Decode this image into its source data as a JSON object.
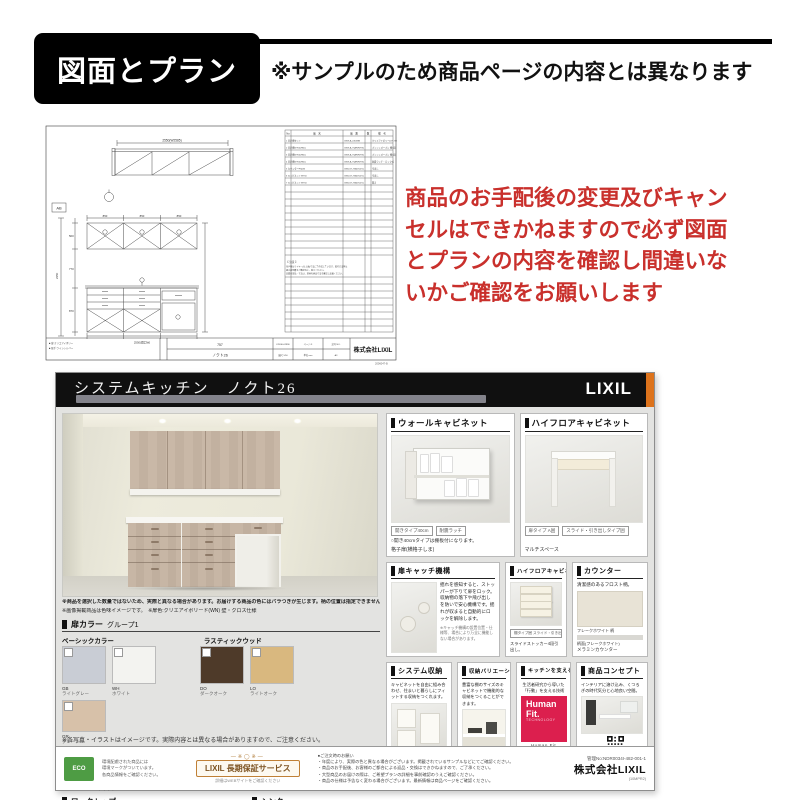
{
  "header": {
    "title": "図面とプラン",
    "disclaimer": "※サンプルのため商品ページの内容とは異なります"
  },
  "warning": {
    "line1": "商品のお手配後の変更及びキャン",
    "line2": "セルはできかねますので必ず図面",
    "line3": "とプランの内容を確認し間違いな",
    "line4": "いかご確認をお願いします"
  },
  "colors": {
    "accent_red": "#c9302c",
    "lixil_orange": "#dd731c",
    "human_fit_red": "#dc1f4e",
    "eco_green": "#4e9c44"
  },
  "drawing": {
    "plan_dim": "2550(W2585)",
    "ref_box": "AB",
    "dim_850a": "850",
    "dim_850b": "850",
    "dim_850c": "850",
    "dim_total": "2550(間口W)",
    "dim_h1": "500",
    "dim_h2": "770",
    "dim_h3": "870",
    "dim_htotal": "2350",
    "tbl_h_no": "No",
    "tbl_h_name": "品　名",
    "tbl_h_code": "品　番",
    "tbl_h_qty": "数",
    "tbl_h_note": "備　考",
    "rows": [
      {
        "a": "1 吊戸棚セット",
        "b": "GKW-A-245ZBN",
        "c": "クリエアイボリー(LH-755)"
      },
      {
        "a": "2 吊戸棚W750(H50)",
        "b": "GKW-A-75AF(R/TN)",
        "c": "プッシュオープン 棚1段"
      },
      {
        "a": "3 吊戸棚W750(H50)",
        "b": "GKW-A-75AF(R/TN)",
        "c": "プッシュオープン 棚1段"
      },
      {
        "a": "4 吊戸棚W750(H50)",
        "b": "GKW-A-75AF(R/TN)",
        "c": "耐震ラッチ・ロック式"
      },
      {
        "a": "5 カウンターFS(W)",
        "b": "GKB-ST-75A6T(2%)",
        "c": "引出し"
      },
      {
        "a": "6 キャビネットW750",
        "b": "GKB-ST-75A6T(2%)",
        "c": "引出し"
      },
      {
        "a": "7 キャビネットW750",
        "b": "GKB-ST-75A6T(2%)",
        "c": "開き"
      }
    ],
    "note1": "【 注意 】",
    "note2a": "吊戸棚はワイヤー(仕上面)寸法にて作成しています。取付方法等は",
    "note2b": "組立説明書をご確認の上、施工ください。",
    "note3": "記載の部品・寸法は、現地の納品寸法を確認し設置ください。",
    "tb_left1": "■ 扉:クリエアイボリー",
    "tb_left2": "■ 取手:ラインシルバー",
    "tb_mid_top": "757",
    "tb_mid_bottom": "ノクト26",
    "g1": "K2630-02996",
    "g2": "ページ-3",
    "g3": "記号 NO.",
    "g4": "縮尺 1/50",
    "g5": "単位 mm",
    "g6": "A3",
    "company": "株式会社LIXIL",
    "corner_note": "2006047-B"
  },
  "sheet": {
    "title": "システムキッチン　ノクト26",
    "brand": "LIXIL",
    "render_note1": "※商品を選択した数量ではないため、実際と異なる場合があります。お届けする商品の色にはバラつきが生じます。柄の位置は指定できません。",
    "render_note2": "※画像掲載商品は色味イメージです。　※扉色:クリエアイボリード(WN) 壁・クロス仕様",
    "door_color": {
      "label": "扉カラー",
      "group": "グループ1",
      "cat1": "ベーシックカラー",
      "cat2": "ラスティックウッド",
      "swatches": [
        {
          "code": "GB",
          "name": "ライトグレー",
          "color": "#c9cdd5"
        },
        {
          "code": "WH",
          "name": "ホワイト",
          "color": "#f3f3f0"
        },
        {
          "code": "DO",
          "name": "ダークオーク",
          "color": "#4e3a29"
        },
        {
          "code": "LO",
          "name": "ライトオーク",
          "color": "#d9b87f"
        },
        {
          "code": "GR",
          "name": "グレージュ",
          "color": "#d7c1a9"
        }
      ]
    },
    "handle": {
      "label": "取手",
      "note": "※取手もお選び頂けます。",
      "h1": "Cライン取手",
      "h1b": "シルバー",
      "h2": "バー取手",
      "h2b": "ブラック"
    },
    "worktop": {
      "label": "ワークトップ",
      "btn": "詳細へ"
    },
    "sink": {
      "label": "シンク",
      "btn": "詳細へ"
    },
    "panels": {
      "wall": {
        "title": "ウォールキャビネット",
        "chip1": "開きタイプ40cm",
        "chip2": "耐震ラッチ",
        "cap": "○開き40cmタイプは棚板付になります。",
        "foot": "格子扉(横格子しま)"
      },
      "highfloor": {
        "title": "ハイフロアキャビネット",
        "chip1": "扉タイプ A囲",
        "chip2": "スライド・引き出しタイプ囲",
        "foot": "マルチスペース"
      },
      "catch": {
        "title": "扉キャッチ機構",
        "desc": "揺れを感知すると、ストッパーが下りて扉をロック。収納物の落下や飛び出しを防いで安心機構です。揺れが収まると自動的にロックを解除します。",
        "note": "※キャッチ機構の設置位置・仕様等、場合により万全に機能しない場合があります。"
      },
      "highfloor2": {
        "title": "ハイフロアキャビネット",
        "chip1": "棚タイプ囲 スライド・引き出し囲",
        "cap": "スライドストッカー4段引出し。"
      },
      "counter": {
        "title": "カウンター",
        "desc": "清潔感のあるフロスト柄。",
        "s1": "フレークホワイト 柄",
        "s2": "柄面(フレークホワイト)",
        "foot": "メラミンカウンター"
      },
      "storage": {
        "title": "システム収納",
        "desc": "キャビネットを自由に組み合わせ、住まいと暮らしにフィットする収納をつくれます。"
      },
      "variation": {
        "title": "収納バリエーション",
        "desc": "豊富な棚のサイズのキャビネットで機能的な収納をつくることができます。"
      },
      "tech": {
        "title": "キッチンを支える技術",
        "desc": "生活者研究から導いた「行動」を支える技術",
        "logo1": "Human",
        "logo2": "Fit.",
        "logo3": "TECHNOLOGY",
        "cap": "Human Fit Technology"
      },
      "concept": {
        "title": "商品コンセプト",
        "desc": "インテリアに溶け込み、くつろぎの時代気分と心地良い空間。",
        "qr_cap": "詳細はこちら"
      }
    },
    "note": "※各写真・イラストはイメージです。実際内容とは異なる場合がありますので、ご注意ください。",
    "footer": {
      "eco_badge": "ECO",
      "eco1": "環境配慮された商品には",
      "eco2": "環境マークがついています。",
      "eco3": "各商品情報をご確認ください。",
      "warranty_deco": "―※◯※―",
      "warranty": "LIXIL 長期保証サービス",
      "warranty_sub": "詳細はWEBサイトをご確認ください",
      "fine1": "●ご注文時のお願い",
      "fine2": "・年度により、実際の色と異なる場合がございます。掲載されているサンプルなどにてご確認ください。",
      "fine3": "・商品のお手配後、お客様のご都合による返品・交換はできかねますので、ご了承ください。",
      "fine4": "・大型商品のお届けの際は、ご希望プランの詳細を事前確認のうえご確認ください。",
      "fine5": "・商品の仕様は予告なく変わる場合がございます。最新情報は商品ページをご確認ください。",
      "doc_no": "管理No:NDR0034I-482-001-1",
      "company": "株式会社LIXIL",
      "company_sub": "(10MPR2)"
    }
  }
}
